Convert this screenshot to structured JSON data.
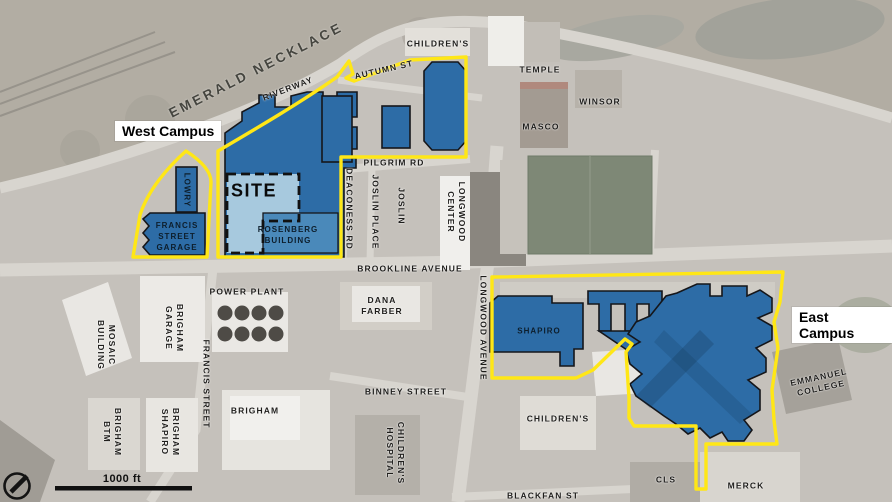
{
  "title": "Longwood Medical Area campus map",
  "legend": {
    "west_campus": "West Campus",
    "east_campus": "East Campus"
  },
  "colors": {
    "building_blue": "#2d6ca6",
    "building_blue_medium": "#4a89ba",
    "site_blue": "#a7c9de",
    "boundary_yellow": "#ffe716",
    "field_green": "#7e8876",
    "aerial_base": "#c5c1bb"
  },
  "scale_bar": {
    "label": "1000 ft"
  },
  "labels": [
    {
      "name": "emerald-necklace",
      "text": "EMERALD NECKLACE",
      "x": 256,
      "y": 70,
      "rot": -27,
      "cls": "park"
    },
    {
      "name": "riverway",
      "text": "RIVERWAY",
      "x": 288,
      "y": 89,
      "rot": -21,
      "cls": "street"
    },
    {
      "name": "autumn-st",
      "text": "AUTUMN ST",
      "x": 384,
      "y": 70,
      "rot": -13,
      "cls": "street"
    },
    {
      "name": "childrens-north",
      "text": "CHILDREN'S",
      "x": 438,
      "y": 44,
      "rot": 0,
      "cls": "street"
    },
    {
      "name": "temple",
      "text": "TEMPLE",
      "x": 540,
      "y": 70,
      "rot": 0,
      "cls": "street"
    },
    {
      "name": "winsor",
      "text": "WINSOR",
      "x": 600,
      "y": 102,
      "rot": 0,
      "cls": "street"
    },
    {
      "name": "masco",
      "text": "MASCO",
      "x": 541,
      "y": 127,
      "rot": 0,
      "cls": "street"
    },
    {
      "name": "pilgrim-rd",
      "text": "PILGRIM RD",
      "x": 394,
      "y": 163,
      "rot": 0,
      "cls": "street"
    },
    {
      "name": "deaconess-rd",
      "text": "DEACONESS RD",
      "x": 349,
      "y": 209,
      "rot": 90,
      "cls": "street"
    },
    {
      "name": "joslin-place",
      "text": "JOSLIN PLACE",
      "x": 375,
      "y": 212,
      "rot": 90,
      "cls": "street"
    },
    {
      "name": "joslin",
      "text": "JOSLIN",
      "x": 401,
      "y": 206,
      "rot": 90,
      "cls": "street"
    },
    {
      "name": "longwood-center",
      "text": "LONGWOOD\nCENTER",
      "x": 456,
      "y": 212,
      "rot": 90,
      "cls": "street"
    },
    {
      "name": "brookline-avenue",
      "text": "BROOKLINE AVENUE",
      "x": 410,
      "y": 269,
      "rot": 0,
      "cls": "street"
    },
    {
      "name": "longwood-avenue",
      "text": "LONGWOOD AVENUE",
      "x": 483,
      "y": 328,
      "rot": 90,
      "cls": "street"
    },
    {
      "name": "power-plant",
      "text": "POWER PLANT",
      "x": 247,
      "y": 292,
      "rot": 0,
      "cls": "street"
    },
    {
      "name": "dana-farber",
      "text": "DANA\nFARBER",
      "x": 382,
      "y": 306,
      "rot": 0,
      "cls": "street"
    },
    {
      "name": "mosaic-building",
      "text": "MOSAIC\nBUILDING",
      "x": 106,
      "y": 345,
      "rot": 90,
      "cls": "street"
    },
    {
      "name": "brigham-garage",
      "text": "BRIGHAM\nGARAGE",
      "x": 174,
      "y": 328,
      "rot": 90,
      "cls": "street"
    },
    {
      "name": "francis-street",
      "text": "FRANCIS STREET",
      "x": 206,
      "y": 384,
      "rot": 90,
      "cls": "street"
    },
    {
      "name": "brigham",
      "text": "BRIGHAM",
      "x": 255,
      "y": 411,
      "rot": 0,
      "cls": "street"
    },
    {
      "name": "brigham-btm",
      "text": "BRIGHAM\nBTM",
      "x": 112,
      "y": 432,
      "rot": 90,
      "cls": "street"
    },
    {
      "name": "brigham-shapiro",
      "text": "BRIGHAM\nSHAPIRO",
      "x": 170,
      "y": 432,
      "rot": 90,
      "cls": "street"
    },
    {
      "name": "binney-street",
      "text": "BINNEY STREET",
      "x": 406,
      "y": 392,
      "rot": 0,
      "cls": "street"
    },
    {
      "name": "childrens-hospital",
      "text": "CHILDREN'S\nHOSPITAL",
      "x": 395,
      "y": 453,
      "rot": 90,
      "cls": "street"
    },
    {
      "name": "childrens-south",
      "text": "CHILDREN'S",
      "x": 558,
      "y": 419,
      "rot": 0,
      "cls": "street"
    },
    {
      "name": "blackfan-st",
      "text": "BLACKFAN ST",
      "x": 543,
      "y": 496,
      "rot": 0,
      "cls": "street"
    },
    {
      "name": "cls",
      "text": "CLS",
      "x": 666,
      "y": 480,
      "rot": 0,
      "cls": "street"
    },
    {
      "name": "merck",
      "text": "MERCK",
      "x": 746,
      "y": 486,
      "rot": 0,
      "cls": "street"
    },
    {
      "name": "emmanuel-college",
      "text": "EMMANUEL\nCOLLEGE",
      "x": 820,
      "y": 383,
      "rot": -12,
      "cls": "street"
    },
    {
      "name": "shapiro",
      "text": "SHAPIRO",
      "x": 539,
      "y": 332,
      "rot": 0,
      "cls": "onblue"
    },
    {
      "name": "rosenberg-building",
      "text": "ROSENBERG\nBUILDING",
      "x": 288,
      "y": 236,
      "rot": 0,
      "cls": "onblue"
    },
    {
      "name": "lowry",
      "text": "LOWRY",
      "x": 186,
      "y": 190,
      "rot": 90,
      "cls": "onblue"
    },
    {
      "name": "francis-street-garage",
      "text": "FRANCIS\nSTREET\nGARAGE",
      "x": 177,
      "y": 237,
      "rot": 0,
      "cls": "onblue"
    },
    {
      "name": "site",
      "text": "SITE",
      "x": 254,
      "y": 191,
      "rot": 0,
      "cls": "site"
    },
    {
      "name": "scale-1000ft",
      "text": "1000 ft",
      "x": 122,
      "y": 479,
      "rot": 0,
      "cls": "scale"
    }
  ]
}
